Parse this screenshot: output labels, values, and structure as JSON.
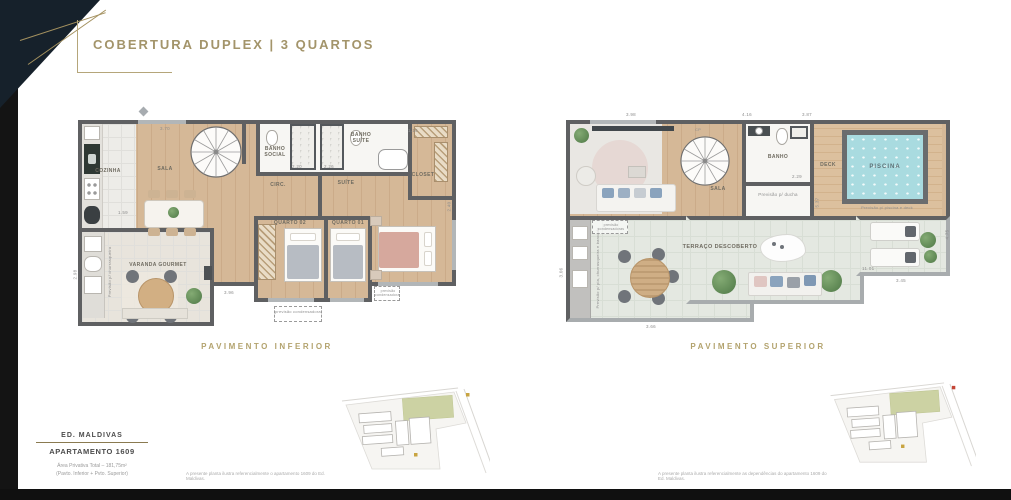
{
  "header": {
    "title": "COBERTURA DUPLEX | 3 QUARTOS"
  },
  "theme": {
    "accent_gold": "#a3946a",
    "wall_gray": "#5f6062",
    "pool_blue": "#a9dbe0",
    "site_green": "#ccd2a3",
    "dark_corner": "#16212b"
  },
  "plans": {
    "inferior": {
      "caption": "PAVIMENTO INFERIOR",
      "rooms": {
        "cozinha": "COZINHA",
        "sala": "SALA",
        "circ": "CIRC.",
        "banho_social": "BANHO SOCIAL",
        "banho_suite": "BANHO SUÍTE",
        "closet": "CLOSET",
        "suite": "SUÍTE",
        "quarto01": "QUARTO 01",
        "quarto02": "QUARTO 02",
        "varanda": "VARANDA GOURMET"
      },
      "notes": {
        "condensadoras": "previsão condensadoras",
        "churrasqueira": "Previsão p/ churrasqueira"
      },
      "dims": [
        "3.70",
        "1.59",
        "2.20",
        "2.26",
        "2.40",
        "1.16",
        "2.98",
        "3.96"
      ]
    },
    "superior": {
      "caption": "PAVIMENTO SUPERIOR",
      "rooms": {
        "sala": "SALA",
        "banho": "BANHO",
        "deck": "DECK",
        "piscina": "PISCINA",
        "terraco": "TERRAÇO DESCOBERTO"
      },
      "labels": {
        "cp": "CP"
      },
      "notes": {
        "ducha": "Previsão p/ ducha",
        "piscina_deck": "Previsão p/ piscina e deck",
        "condensadoras": "previsão condensadoras",
        "bancada": "Previsão p/ pia, churrasqueira e bancada"
      },
      "dims": [
        "4.16",
        "3.87",
        "2.29",
        "5.37",
        "3.98",
        "3.06",
        "11.01",
        "3.45",
        "4.75",
        "3.66"
      ]
    }
  },
  "info": {
    "building": "ED. MALDIVAS",
    "apartment": "APARTAMENTO 1609",
    "area_line1": "Área Privativa Total – 181,75m²",
    "area_line2": "(Pavto. Inferior + Pvto. Superior)"
  },
  "site": {
    "left_note": "A presente planta ilustra referencialmente o apartamento 1609 do Ed. Maldivas.",
    "right_note": "A presente planta ilustra referencialmente as dependências do apartamento 1609 do Ed. Maldivas."
  }
}
